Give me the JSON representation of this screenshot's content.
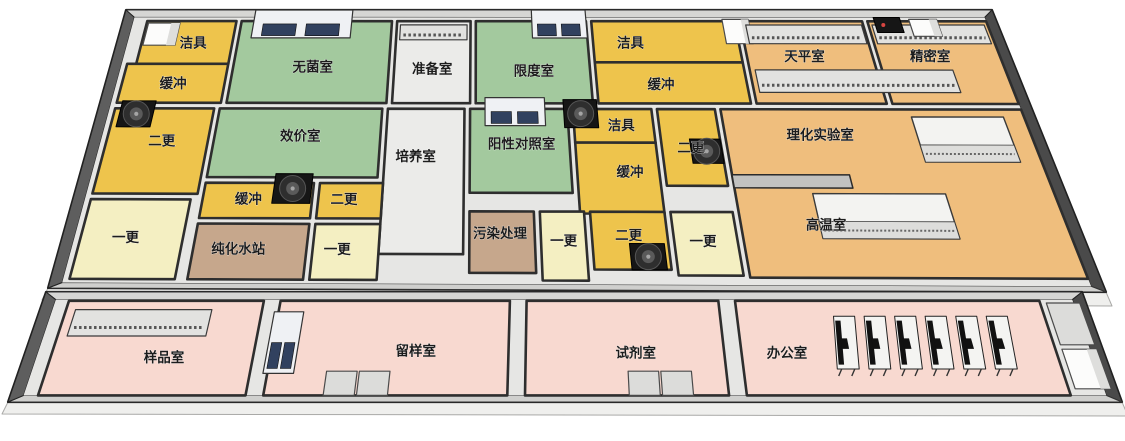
{
  "page": {
    "background": "#ffffff",
    "description_label": ""
  },
  "colors": {
    "yellow": "#EEC44C",
    "pale_yellow": "#F4EFC2",
    "green": "#A3C99E",
    "orange": "#EFBE7D",
    "pink": "#F8D9D0",
    "brown": "#C6A78C",
    "corridor": "#EBEBE9",
    "floor": "#E6E6E4",
    "wall_top": "#D6D6D4",
    "wall_left": "#5E5E5E",
    "wall_right": "#4A4A4A",
    "wall_bottom": "#CFCFCD",
    "wall_line": "#2E2E2E",
    "skirt": "#EFEFED",
    "label_text": "#1C1C1C",
    "cabinet_blue": "#31415F",
    "fan_black": "#161616",
    "device_red": "#D64541"
  },
  "floorplan": {
    "blocks": {
      "main": {
        "corners": [
          [
            126,
            10
          ],
          [
            992,
            10
          ],
          [
            1106,
            292
          ],
          [
            48,
            288
          ]
        ],
        "vmax": 300,
        "inner": [
          12,
          8,
          988,
          294
        ]
      },
      "annex": {
        "corners": [
          [
            46,
            292
          ],
          [
            1082,
            292
          ],
          [
            1122,
            402
          ],
          [
            8,
            402
          ]
        ],
        "vmax": 100,
        "inner": [
          12,
          7,
          988,
          94
        ]
      }
    },
    "rooms": [
      {
        "id": "jieju-1",
        "label": "洁具",
        "color": "yellow",
        "block": "main",
        "rect": [
          28,
          12,
          130,
          58
        ],
        "label_pos": [
          86,
          36
        ]
      },
      {
        "id": "huanchong-1",
        "label": "缓冲",
        "color": "yellow",
        "block": "main",
        "rect": [
          18,
          58,
          130,
          100
        ],
        "label_pos": [
          74,
          80
        ]
      },
      {
        "id": "wujunshi",
        "label": "无菌室",
        "color": "green",
        "block": "main",
        "rect": [
          136,
          12,
          308,
          100
        ],
        "label_pos": [
          224,
          62
        ]
      },
      {
        "id": "zhunbeishi",
        "label": "准备室",
        "color": "corridor",
        "block": "main",
        "rect": [
          314,
          12,
          398,
          100
        ],
        "label_pos": [
          356,
          64
        ]
      },
      {
        "id": "xiandushi",
        "label": "限度室",
        "color": "green",
        "block": "main",
        "rect": [
          404,
          12,
          530,
          100
        ],
        "label_pos": [
          468,
          66
        ]
      },
      {
        "id": "jieju-2",
        "label": "洁具",
        "color": "yellow",
        "block": "main",
        "rect": [
          536,
          12,
          700,
          56
        ],
        "label_pos": [
          578,
          36
        ]
      },
      {
        "id": "huanchong-2",
        "label": "缓冲",
        "color": "yellow",
        "block": "main",
        "rect": [
          536,
          56,
          700,
          100
        ],
        "label_pos": [
          606,
          80
        ]
      },
      {
        "id": "tianpingshi",
        "label": "天平室",
        "color": "orange",
        "block": "main",
        "rect": [
          706,
          12,
          846,
          100
        ],
        "label_pos": [
          770,
          50
        ]
      },
      {
        "id": "jingmishi",
        "label": "精密室",
        "color": "orange",
        "block": "main",
        "rect": [
          852,
          12,
          988,
          100
        ],
        "label_pos": [
          910,
          50
        ]
      },
      {
        "id": "ergeng-1",
        "label": "二更",
        "color": "yellow",
        "block": "main",
        "rect": [
          18,
          106,
          124,
          198
        ],
        "label_pos": [
          76,
          142
        ]
      },
      {
        "id": "xiaojiashi",
        "label": "效价室",
        "color": "green",
        "block": "main",
        "rect": [
          130,
          106,
          304,
          180
        ],
        "label_pos": [
          220,
          136
        ]
      },
      {
        "id": "peiyangshi",
        "label": "培养室",
        "color": "corridor",
        "block": "main",
        "rect": [
          310,
          106,
          392,
          262
        ],
        "label_pos": [
          342,
          158
        ]
      },
      {
        "id": "yangxingduizhaoshi",
        "label": "阳性对照室",
        "color": "green",
        "block": "main",
        "rect": [
          398,
          106,
          502,
          196
        ],
        "label_pos": [
          452,
          144
        ]
      },
      {
        "id": "jieju-3",
        "label": "洁具",
        "color": "yellow",
        "block": "main",
        "rect": [
          508,
          106,
          592,
          142
        ],
        "label_pos": [
          558,
          124
        ]
      },
      {
        "id": "huanchong-3",
        "label": "缓冲",
        "color": "yellow",
        "block": "main",
        "rect": [
          508,
          142,
          592,
          218
        ],
        "label_pos": [
          562,
          174
        ]
      },
      {
        "id": "ergeng-2",
        "label": "二更",
        "color": "yellow",
        "block": "main",
        "rect": [
          598,
          106,
          660,
          188
        ],
        "label_pos": [
          628,
          148
        ]
      },
      {
        "id": "lihuashiyanshi",
        "label": "理化实验室",
        "color": "orange",
        "block": "main",
        "rect": [
          666,
          106,
          988,
          286
        ],
        "label_pos": [
          766,
          134
        ]
      },
      {
        "id": "yigeng-1",
        "label": "一更",
        "color": "pale_yellow",
        "block": "main",
        "rect": [
          18,
          204,
          118,
          290
        ],
        "label_pos": [
          62,
          246
        ]
      },
      {
        "id": "huanchong-4",
        "label": "缓冲",
        "color": "yellow",
        "block": "main",
        "rect": [
          130,
          186,
          240,
          224
        ],
        "label_pos": [
          176,
          204
        ]
      },
      {
        "id": "ergeng-3",
        "label": "二更",
        "color": "yellow",
        "block": "main",
        "rect": [
          246,
          186,
          310,
          224
        ],
        "label_pos": [
          272,
          204
        ]
      },
      {
        "id": "chunhuashuizhan",
        "label": "纯化水站",
        "color": "brown",
        "block": "main",
        "rect": [
          130,
          230,
          240,
          290
        ],
        "label_pos": [
          174,
          258
        ]
      },
      {
        "id": "yigeng-2",
        "label": "一更",
        "color": "pale_yellow",
        "block": "main",
        "rect": [
          246,
          230,
          310,
          290
        ],
        "label_pos": [
          270,
          258
        ]
      },
      {
        "id": "wuranchuli",
        "label": "污染处理",
        "color": "brown",
        "block": "main",
        "rect": [
          398,
          216,
          462,
          282
        ],
        "label_pos": [
          428,
          240
        ]
      },
      {
        "id": "yigeng-3",
        "label": "一更",
        "color": "pale_yellow",
        "block": "main",
        "rect": [
          468,
          216,
          512,
          290
        ],
        "label_pos": [
          490,
          248
        ]
      },
      {
        "id": "ergeng-4",
        "label": "二更",
        "color": "yellow",
        "block": "main",
        "rect": [
          518,
          216,
          592,
          278
        ],
        "label_pos": [
          554,
          242
        ]
      },
      {
        "id": "yigeng-4",
        "label": "一更",
        "color": "pale_yellow",
        "block": "main",
        "rect": [
          598,
          216,
          660,
          284
        ],
        "label_pos": [
          626,
          248
        ]
      },
      {
        "id": "yangpinshi",
        "label": "样品室",
        "color": "pink",
        "block": "annex",
        "rect": [
          25,
          8,
          212,
          94
        ],
        "label_pos": [
          130,
          60
        ]
      },
      {
        "id": "liuyangshi",
        "label": "留样室",
        "color": "pink",
        "block": "annex",
        "rect": [
          228,
          8,
          448,
          94
        ],
        "label_pos": [
          362,
          54
        ]
      },
      {
        "id": "shijishi",
        "label": "试剂室",
        "color": "pink",
        "block": "annex",
        "rect": [
          464,
          8,
          648,
          94
        ],
        "label_pos": [
          566,
          56
        ]
      },
      {
        "id": "bangongshi",
        "label": "办公室",
        "color": "pink",
        "block": "annex",
        "rect": [
          664,
          8,
          956,
          94
        ],
        "label_pos": [
          706,
          56
        ]
      }
    ],
    "free_labels": [
      {
        "label": "高温室",
        "block": "main",
        "pos": [
          750,
          230
        ]
      }
    ],
    "equipment": [
      {
        "type": "white-box",
        "block": "main",
        "rect": [
          30,
          14,
          66,
          38
        ]
      },
      {
        "type": "cabinet-blue",
        "block": "main",
        "rect": [
          150,
          0,
          262,
          30
        ]
      },
      {
        "type": "cabinet-blue",
        "block": "main",
        "rect": [
          468,
          0,
          530,
          30
        ]
      },
      {
        "type": "hatch-bench",
        "block": "main",
        "rect": [
          318,
          16,
          394,
          32
        ]
      },
      {
        "type": "white-box",
        "block": "main",
        "rect": [
          686,
          10,
          716,
          36
        ]
      },
      {
        "type": "hatch-bench",
        "block": "main",
        "rect": [
          712,
          16,
          844,
          36
        ]
      },
      {
        "type": "hatch-bench",
        "block": "main",
        "rect": [
          856,
          16,
          984,
          36
        ]
      },
      {
        "type": "device-black",
        "block": "main",
        "rect": [
          860,
          8,
          890,
          24
        ]
      },
      {
        "type": "white-box",
        "block": "main",
        "rect": [
          900,
          10,
          932,
          28
        ]
      },
      {
        "type": "hatch-bench",
        "block": "main",
        "rect": [
          712,
          64,
          930,
          88
        ]
      },
      {
        "type": "fan-black",
        "block": "main",
        "rect": [
          24,
          98,
          60,
          126
        ]
      },
      {
        "type": "cabinet-blue",
        "block": "main",
        "rect": [
          414,
          94,
          478,
          124
        ]
      },
      {
        "type": "fan-black",
        "block": "main",
        "rect": [
          498,
          96,
          534,
          126
        ]
      },
      {
        "type": "fan-black",
        "block": "main",
        "rect": [
          628,
          138,
          660,
          164
        ]
      },
      {
        "type": "fan-black",
        "block": "main",
        "rect": [
          200,
          176,
          238,
          208
        ]
      },
      {
        "type": "fan-black",
        "block": "main",
        "rect": [
          554,
          250,
          588,
          278
        ]
      },
      {
        "type": "bench-white",
        "block": "main",
        "rect": [
          868,
          114,
          966,
          162
        ]
      },
      {
        "type": "bench-white",
        "block": "main",
        "rect": [
          744,
          196,
          878,
          244
        ]
      },
      {
        "type": "wall-block",
        "block": "main",
        "rect": [
          666,
          176,
          786,
          190
        ]
      },
      {
        "type": "hatch-bench",
        "block": "annex",
        "rect": [
          34,
          16,
          164,
          40
        ]
      },
      {
        "type": "cabinet-blue",
        "block": "annex",
        "rect": [
          224,
          18,
          252,
          74
        ]
      },
      {
        "type": "gray-box",
        "block": "annex",
        "rect": [
          282,
          72,
          310,
          94
        ]
      },
      {
        "type": "gray-box",
        "block": "annex",
        "rect": [
          312,
          72,
          340,
          94
        ]
      },
      {
        "type": "gray-box",
        "block": "annex",
        "rect": [
          558,
          72,
          586,
          94
        ]
      },
      {
        "type": "gray-box",
        "block": "annex",
        "rect": [
          588,
          72,
          616,
          94
        ]
      },
      {
        "type": "desk",
        "block": "annex",
        "rect": [
          750,
          22,
          770,
          70
        ]
      },
      {
        "type": "desk",
        "block": "annex",
        "rect": [
          779,
          22,
          799,
          70
        ]
      },
      {
        "type": "desk",
        "block": "annex",
        "rect": [
          808,
          22,
          828,
          70
        ]
      },
      {
        "type": "desk",
        "block": "annex",
        "rect": [
          837,
          22,
          857,
          70
        ]
      },
      {
        "type": "desk",
        "block": "annex",
        "rect": [
          866,
          22,
          886,
          70
        ]
      },
      {
        "type": "desk",
        "block": "annex",
        "rect": [
          895,
          22,
          915,
          70
        ]
      },
      {
        "type": "gray-box",
        "block": "annex",
        "rect": [
          962,
          10,
          994,
          48
        ]
      },
      {
        "type": "white-box",
        "block": "annex",
        "rect": [
          962,
          52,
          994,
          88
        ]
      }
    ]
  }
}
